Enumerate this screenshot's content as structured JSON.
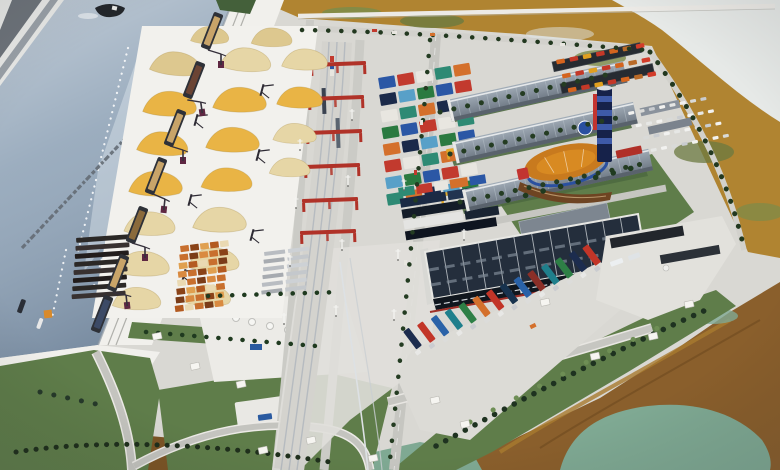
{
  "scene": {
    "kind": "photograph",
    "subject": "aerial-view-of-scale-model-of-multimodal-river-port-logistics-complex",
    "quay_inscription_legible": false,
    "areas": [
      "shipping-canal",
      "opposite-bank",
      "cargo-quay",
      "barges",
      "portal-cranes",
      "covered-bulk-cargo-piles",
      "timber-and-cargo-stacks",
      "railway-terminal",
      "rail-gantry-cranes",
      "container-yard",
      "logistics-warehouses",
      "business-center-with-tower",
      "truck-parking",
      "car-parking",
      "distribution-warehouse",
      "parked-semi-trailers",
      "service-area",
      "green-areas",
      "access-roads",
      "wetland-marsh",
      "marsh-pond"
    ]
  },
  "palette": {
    "base_ground": "#d9d8d3",
    "quay": "#f1f0ec",
    "canal_water": "#8ea2b6",
    "water_glare": "#e6edf3",
    "bank_stripe": "#6e747b",
    "ship_hull": "#23262b",
    "barge_hull": "#2e3138",
    "barge_cargo": "#c8a469",
    "pile_gold": "#e9b445",
    "pile_tan": "#ddc88f",
    "pile_pale": "#e6d6a6",
    "piles_pad": "#f2f1ed",
    "crane_red": "#b03228",
    "rtg_yellow": "#e2a82a",
    "rail_silver": "#b6bbc0",
    "asphalt": "#c6c6c1",
    "road_light": "#d2d1cc",
    "grass": "#5f7d4a",
    "grass_dark": "#44603a",
    "tree_dark": "#22381f",
    "warehouse_roof_light": "#8a95a0",
    "warehouse_roof_dark": "#262b31",
    "dark_warehouse_roof": "#242e3c",
    "dark_warehouse_wall": "#10161e",
    "biz_orange": "#d88a22",
    "biz_blue": "#2a50a0",
    "biz_red": "#c23430",
    "tower_navy": "#16224a",
    "marsh_ochre": "#b08431",
    "marsh_green": "#7c8c4a",
    "marsh_brown": "#8a5f2c",
    "marsh_pond": "#7fa993",
    "dirt": "#7c5526",
    "card_white": "#f6f5f1",
    "apron": "#dcdbd6"
  },
  "container_colors": [
    "#2b57a5",
    "#c23a2e",
    "#e8e6e0",
    "#2e8a74",
    "#d4702c",
    "#1b2a4a",
    "#58a0c8",
    "#2a7a40"
  ],
  "truck_colors": [
    "#1c2c4e",
    "#c23528",
    "#2a62a8",
    "#1f7f8c",
    "#2e7f46",
    "#d4702c",
    "#c23528",
    "#17324e",
    "#2a62a8",
    "#8a2f28",
    "#1f7f8c",
    "#2e7f46",
    "#1c2c4e",
    "#c23528"
  ],
  "north_truck_colors": [
    "#d4641e",
    "#c43828",
    "#e0a020",
    "#c43828",
    "#d4641e",
    "#b86a28",
    "#d23c2a"
  ],
  "car_colors": [
    "#f2f2f0",
    "#d9dad8",
    "#c9ccd0",
    "#f2f2f0",
    "#e6e7e5"
  ],
  "repeats": {
    "containers_upper": {
      "rows": 8,
      "cols": 5,
      "dx": 19,
      "dy": 16.6,
      "rowShift": -1.6,
      "w": 16.5,
      "h": 11.5,
      "rx": 1,
      "colors": "container_colors"
    },
    "timber_grid": {
      "rows": 8,
      "cols": 5,
      "dx": 10,
      "dy": 8.4,
      "rowShift": -1.8,
      "w": 8.6,
      "h": 6.2,
      "rx": 0.5,
      "colors": [
        "#c86f2e",
        "#8a4318",
        "#e0a050",
        "#b35a20",
        "#ead9b2",
        "#c86f2e",
        "#7a3c18",
        "#d98a40"
      ]
    },
    "dark_stacks": {
      "rows": 8,
      "cols": 1,
      "dx": 0,
      "dy": 8,
      "rowShift": -1.2,
      "w": 54,
      "h": 4.8,
      "rx": 1,
      "colors": [
        "#2b2826",
        "#383130",
        "#221d1c"
      ]
    },
    "gray_stacks": {
      "rows": 6,
      "cols": 2,
      "dx": 24,
      "dy": 7.6,
      "rowShift": -1.5,
      "w": 21,
      "h": 4,
      "rx": 0.5,
      "colors": [
        "#b9bdc2",
        "#cdd1d5",
        "#a7abb0",
        "#c4c8cc"
      ]
    },
    "north_trucks": {
      "rows": 3,
      "cols": 7,
      "dx": 13.5,
      "dy": 15,
      "rowShift": 3,
      "w": 8.5,
      "h": 4.5,
      "rx": 1,
      "colors": "north_truck_colors"
    },
    "cars": {
      "rows": 4,
      "cols": 8,
      "dx": 10.5,
      "dy": 13.5,
      "rowShift": 5,
      "w": 6,
      "h": 3.2,
      "rx": 1,
      "colors": "car_colors"
    },
    "truck_trailers": {
      "rows": 1,
      "cols": 14,
      "dx": 15.2,
      "dy": 0,
      "y0": -22,
      "w": 7,
      "h": 22,
      "rx": 1,
      "rot": -12,
      "colors": "truck_colors"
    },
    "truck_cabs": {
      "rows": 1,
      "cols": 14,
      "dx": 15.2,
      "dy": 0,
      "y0": 1.5,
      "w": 5.5,
      "h": 4.5,
      "rx": 1,
      "rot": -12,
      "colors": [
        "#e8e8e6",
        "#caccd0",
        "#dcdcda"
      ]
    }
  }
}
